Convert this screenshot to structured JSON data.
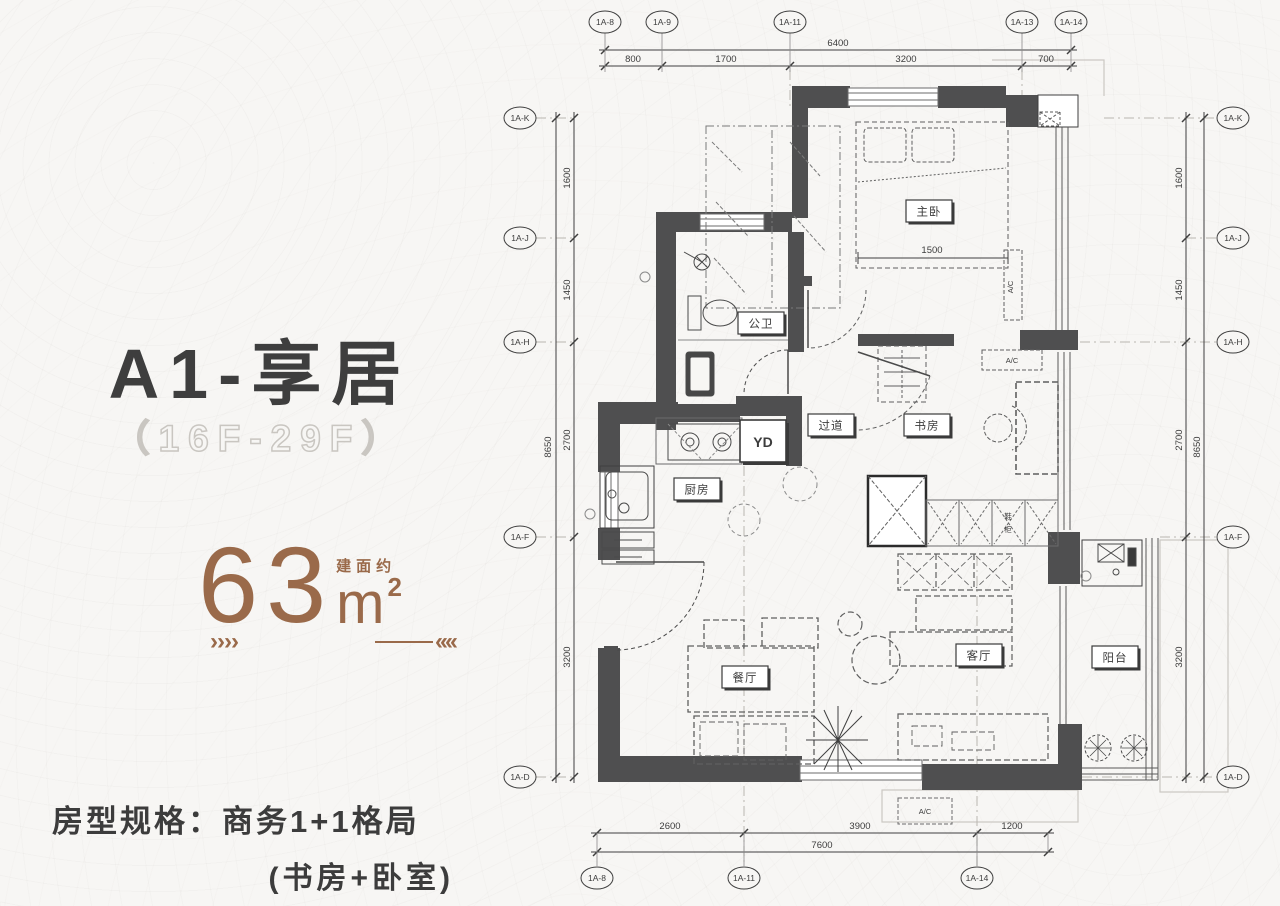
{
  "colors": {
    "accent": "#9a6a4a",
    "ink": "#3c3c3c",
    "wall": "#4f4f50",
    "outline": "#c9c6c1"
  },
  "panel": {
    "title": "A1-享居",
    "floors": "（16F-29F）",
    "area": {
      "prefix": "建面约",
      "value": "63",
      "unit": "m",
      "sup": "2"
    },
    "arrow_left": "››››",
    "arrow_right": "‹‹‹‹",
    "spec_line1": "房型规格：商务1+1格局",
    "spec_line2": "(书房+卧室)"
  },
  "plan": {
    "rooms": {
      "master": "主卧",
      "bath": "公卫",
      "corridor": "过道",
      "study": "书房",
      "kitchen": "厨房",
      "laundry": "YD",
      "dining": "餐厅",
      "living": "客厅",
      "balcony": "阳台",
      "shoe_cab_1": "鞋",
      "shoe_cab_2": "柜",
      "ac": "A/C",
      "bed_width": "1500"
    },
    "axes": {
      "top": [
        "1A-8",
        "1A-9",
        "1A-11",
        "1A-13",
        "1A-14"
      ],
      "bottom": [
        "1A-8",
        "1A-11",
        "1A-14"
      ],
      "side": [
        "1A-K",
        "1A-J",
        "1A-H",
        "1A-F",
        "1A-D"
      ]
    },
    "dims": {
      "top_total": "6400",
      "top_segs": [
        "800",
        "1700",
        "3200",
        "700"
      ],
      "bottom_total": "7600",
      "bottom_segs": [
        "2600",
        "3900",
        "1200"
      ],
      "side_total": "8650",
      "side_segs": [
        "1600",
        "1450",
        "2700",
        "3200"
      ]
    }
  }
}
